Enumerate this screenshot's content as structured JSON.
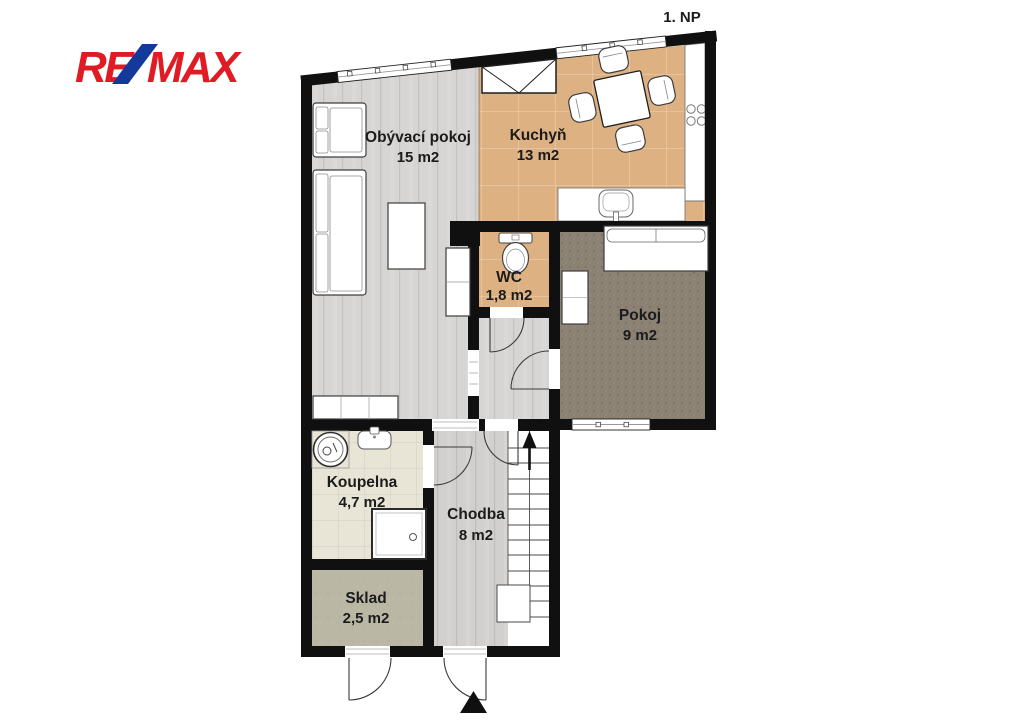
{
  "logo": {
    "re": "RE",
    "slash": "/",
    "max": "MAX"
  },
  "plan": {
    "floor_label": "1. NP"
  },
  "rooms": {
    "obyvaci_pokoj": {
      "name": "Obývací pokoj",
      "area": "15 m2"
    },
    "kuchyn": {
      "name": "Kuchyň",
      "area": "13 m2"
    },
    "wc": {
      "name": "WC",
      "area": "1,8 m2"
    },
    "pokoj": {
      "name": "Pokoj",
      "area": "9 m2"
    },
    "koupelna": {
      "name": "Koupelna",
      "area": "4,7 m2"
    },
    "chodba": {
      "name": "Chodba",
      "area": "8 m2"
    },
    "sklad": {
      "name": "Sklad",
      "area": "2,5 m2"
    }
  },
  "colors": {
    "wall": "#101010",
    "label": "#1b1b1b",
    "brand_red": "#e01b24",
    "brand_blue": "#15399b",
    "living_floor": "#d7d5d3",
    "chodba_floor": "#d2d0ce",
    "kitchen_floor": "#deb183",
    "pokoj_floor": "#8c8273",
    "koupelna_floor": "#e8e5d7",
    "sklad_floor": "#bab7a5"
  }
}
